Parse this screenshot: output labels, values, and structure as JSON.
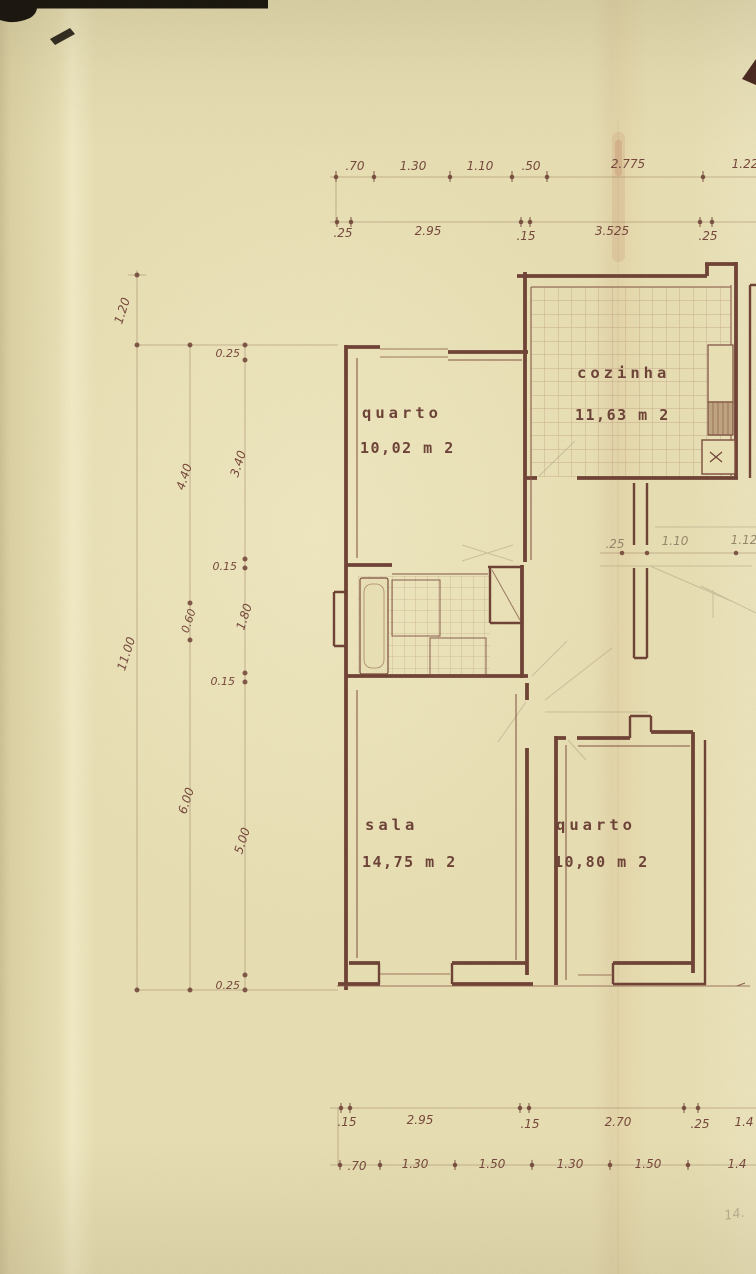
{
  "rooms": {
    "quarto_upper": {
      "name": "quarto",
      "area": "10,02 m 2"
    },
    "cozinha": {
      "name": "cozinha",
      "area": "11,63 m 2"
    },
    "sala": {
      "name": "sala",
      "area": "14,75 m 2"
    },
    "quarto_lower": {
      "name": "quarto",
      "area": "10,80 m 2"
    }
  },
  "dimensions": {
    "top_row_upper": [
      ".70",
      "1.30",
      "1.10",
      ".50",
      "2.775",
      "1.22"
    ],
    "top_row_lower": [
      ".25",
      "2.95",
      ".15",
      "3.525",
      ".25"
    ],
    "left_col_outer": [
      "1.20",
      "11.00"
    ],
    "left_col_middle": [
      "4.40",
      "0.60",
      "6.00"
    ],
    "left_col_inner": [
      "0.25",
      "3.40",
      "0.15",
      "1.80",
      "0.15",
      "5.00",
      "0.25"
    ],
    "interior_row": [
      ".25",
      "1.10",
      "1.12"
    ],
    "bottom_row_upper": [
      ".15",
      "2.95",
      ".15",
      "2.70",
      ".25",
      "1.4"
    ],
    "bottom_row_lower": [
      ".70",
      "1.30",
      "1.50",
      "1.30",
      "1.50",
      "1.4"
    ],
    "handwritten_note": "14."
  },
  "colors": {
    "paper": "#e9e0b5",
    "ink": "#6d4034",
    "tile_line": "#a4785f",
    "pencil": "#a5967a",
    "black_mark": "#15120b"
  }
}
